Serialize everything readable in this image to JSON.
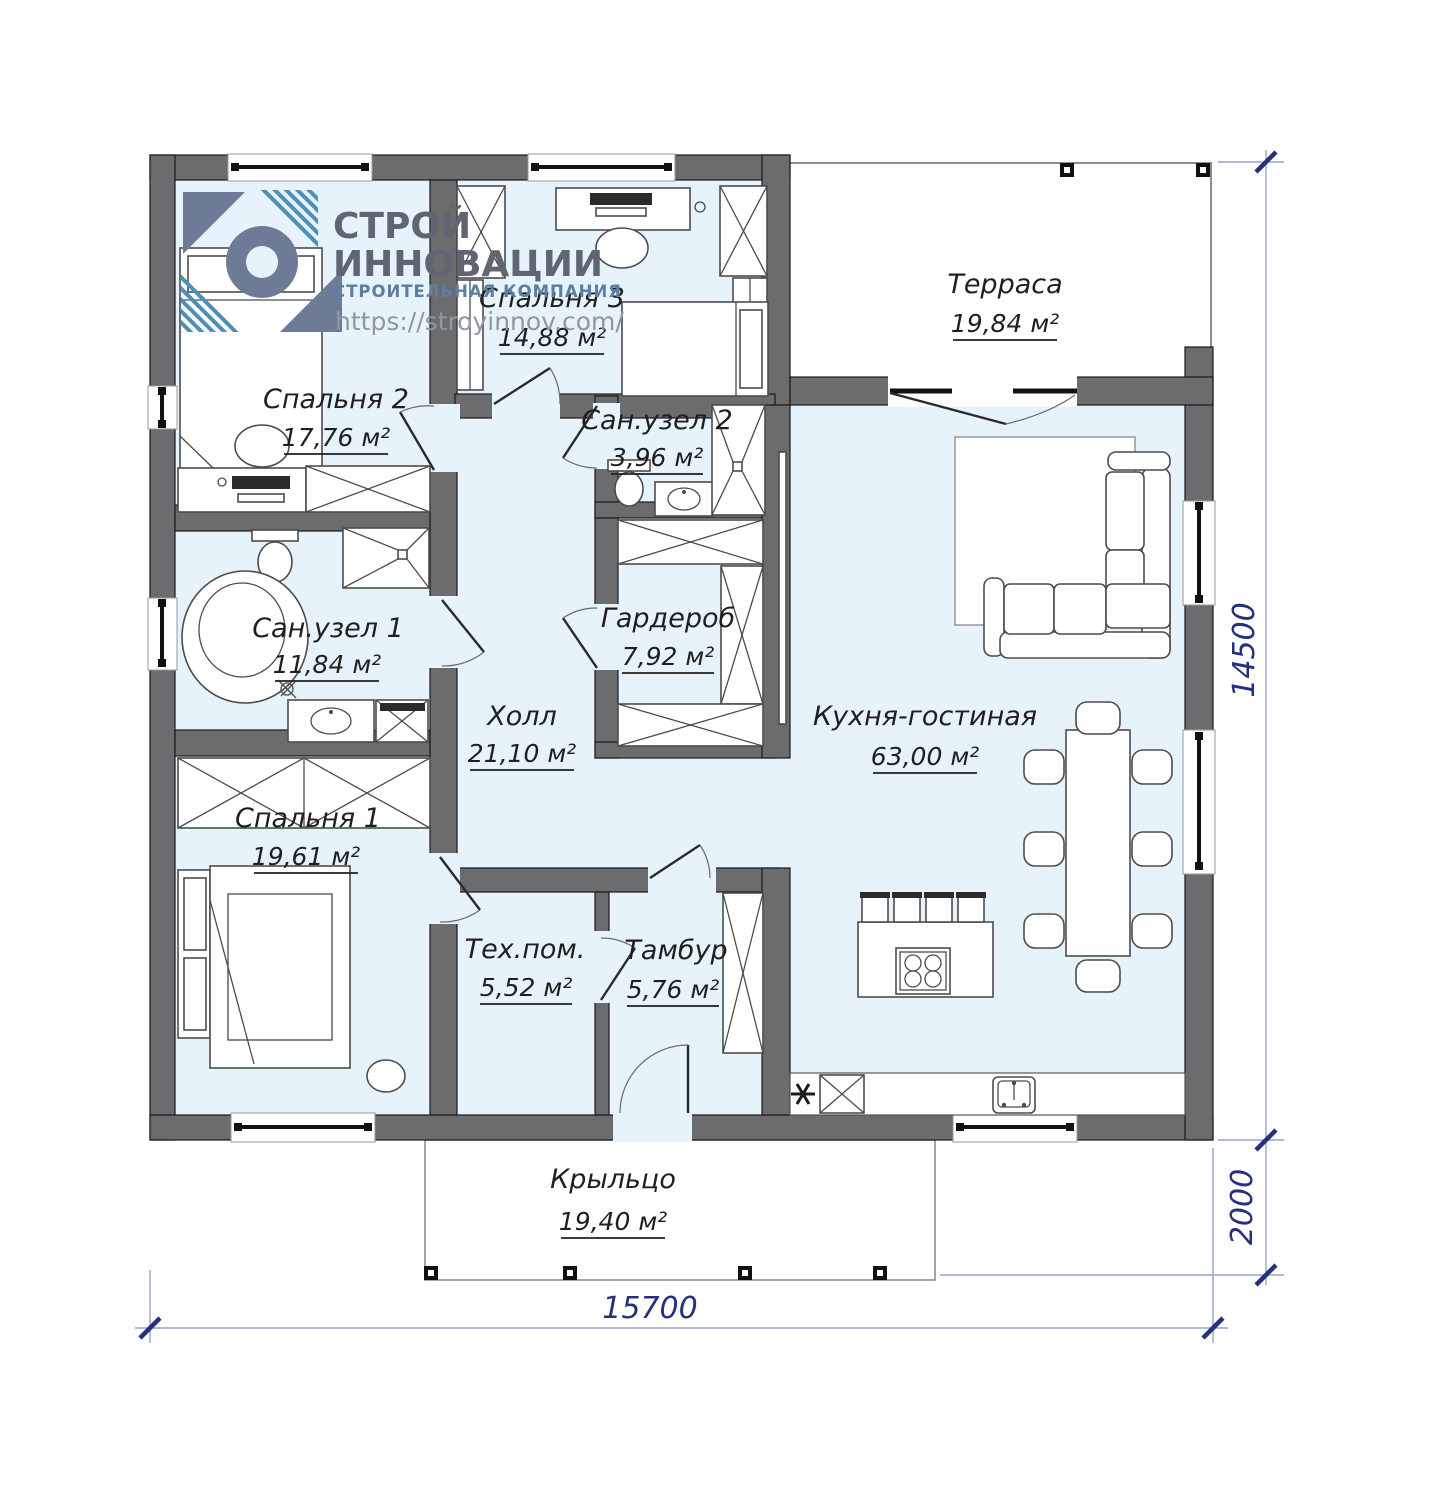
{
  "logo": {
    "line1": "СТРОЙ",
    "line2": "ИННОВАЦИИ",
    "subtitle": "СТРОИТЕЛЬНАЯ КОМПАНИЯ",
    "url": "https://stroyinnov.com/"
  },
  "rooms": [
    {
      "name": "Спальня 2",
      "area": "17,76 м²"
    },
    {
      "name": "Спальня 3",
      "area": "14,88 м²"
    },
    {
      "name": "Терраса",
      "area": "19,84 м²"
    },
    {
      "name": "Сан.узел 2",
      "area": "3,96 м²"
    },
    {
      "name": "Сан.узел 1",
      "area": "11,84 м²"
    },
    {
      "name": "Гардероб",
      "area": "7,92 м²"
    },
    {
      "name": "Холл",
      "area": "21,10 м²"
    },
    {
      "name": "Кухня-гостиная",
      "area": "63,00 м²"
    },
    {
      "name": "Спальня 1",
      "area": "19,61 м²"
    },
    {
      "name": "Тех.пом.",
      "area": "5,52 м²"
    },
    {
      "name": "Тамбур",
      "area": "5,76 м²"
    },
    {
      "name": "Крыльцо",
      "area": "19,40 м²"
    }
  ],
  "dimensions": {
    "bottom": "15700",
    "right": "14500",
    "porch": "2000"
  },
  "colors": {
    "wall": "#6b6c6e",
    "floor": "#e7f3fb",
    "dimension": "#26317e",
    "dim_line": "#97a3c9",
    "logo_primary": "#6d7b97",
    "logo_stripe": "#4d8fb8"
  }
}
